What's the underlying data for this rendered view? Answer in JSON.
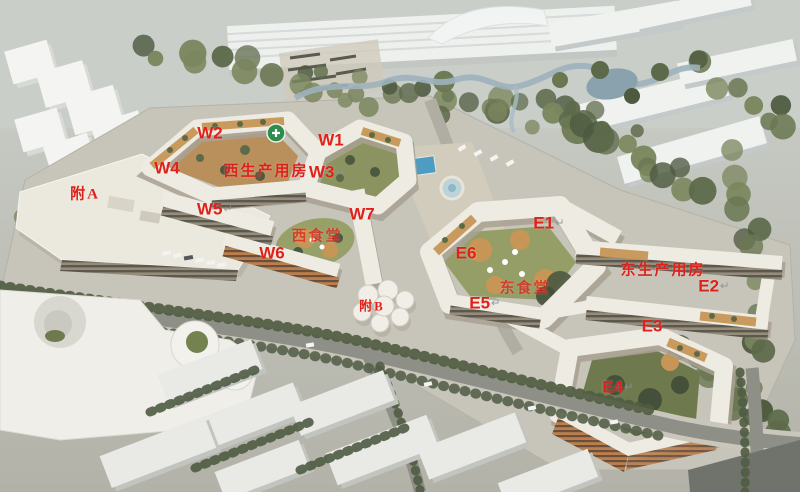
{
  "scene": {
    "label_color": "#e0211a",
    "return_mark": {
      "glyph": "↵",
      "color": "#8b9296"
    },
    "helipad_color": "#2e8c4c",
    "labels": [
      {
        "name": "w2",
        "text": "W2",
        "x": 210,
        "y": 133,
        "size": 17,
        "style": "latin",
        "ret": false,
        "faded": false
      },
      {
        "name": "w1",
        "text": "W1",
        "x": 331,
        "y": 140,
        "size": 17,
        "style": "latin",
        "ret": false,
        "faded": false
      },
      {
        "name": "w4",
        "text": "W4",
        "x": 167,
        "y": 168,
        "size": 17,
        "style": "latin",
        "ret": false,
        "faded": false
      },
      {
        "name": "west-production-building",
        "text": "西生产用房",
        "x": 266,
        "y": 172,
        "size": 15,
        "style": "cjk",
        "ret": false,
        "faded": false
      },
      {
        "name": "w3",
        "text": "W3",
        "x": 327,
        "y": 172,
        "size": 17,
        "style": "latin",
        "ret": true,
        "faded": false
      },
      {
        "name": "annex-a",
        "text": "附A",
        "x": 85,
        "y": 195,
        "size": 15,
        "style": "cjk",
        "ret": false,
        "faded": false
      },
      {
        "name": "w5",
        "text": "W5",
        "x": 215,
        "y": 209,
        "size": 17,
        "style": "latin",
        "ret": true,
        "faded": false
      },
      {
        "name": "w7",
        "text": "W7",
        "x": 362,
        "y": 214,
        "size": 17,
        "style": "latin",
        "ret": false,
        "faded": false
      },
      {
        "name": "e1",
        "text": "E1",
        "x": 549,
        "y": 223,
        "size": 17,
        "style": "latin",
        "ret": true,
        "faded": false
      },
      {
        "name": "west-canteen",
        "text": "西食堂",
        "x": 317,
        "y": 237,
        "size": 15,
        "style": "cjk",
        "ret": false,
        "faded": true
      },
      {
        "name": "e6",
        "text": "E6",
        "x": 466,
        "y": 253,
        "size": 17,
        "style": "latin",
        "ret": false,
        "faded": false
      },
      {
        "name": "w6",
        "text": "W6",
        "x": 272,
        "y": 253,
        "size": 17,
        "style": "latin",
        "ret": false,
        "faded": false
      },
      {
        "name": "east-production-building",
        "text": "东生产用房",
        "x": 663,
        "y": 271,
        "size": 15,
        "style": "cjk",
        "ret": false,
        "faded": false
      },
      {
        "name": "e2",
        "text": "E2",
        "x": 714,
        "y": 286,
        "size": 17,
        "style": "latin",
        "ret": true,
        "faded": false
      },
      {
        "name": "east-canteen",
        "text": "东食堂",
        "x": 525,
        "y": 289,
        "size": 15,
        "style": "cjk",
        "ret": false,
        "faded": true
      },
      {
        "name": "e5",
        "text": "E5",
        "x": 485,
        "y": 303,
        "size": 17,
        "style": "latin",
        "ret": true,
        "faded": false
      },
      {
        "name": "annex-b",
        "text": "附B",
        "x": 372,
        "y": 306,
        "size": 13,
        "style": "cjk",
        "ret": false,
        "faded": false
      },
      {
        "name": "e3",
        "text": "E3",
        "x": 652,
        "y": 326,
        "size": 17,
        "style": "latin",
        "ret": false,
        "faded": false
      },
      {
        "name": "e4",
        "text": "E4",
        "x": 618,
        "y": 387,
        "size": 17,
        "style": "latin",
        "ret": true,
        "faded": false
      }
    ]
  }
}
